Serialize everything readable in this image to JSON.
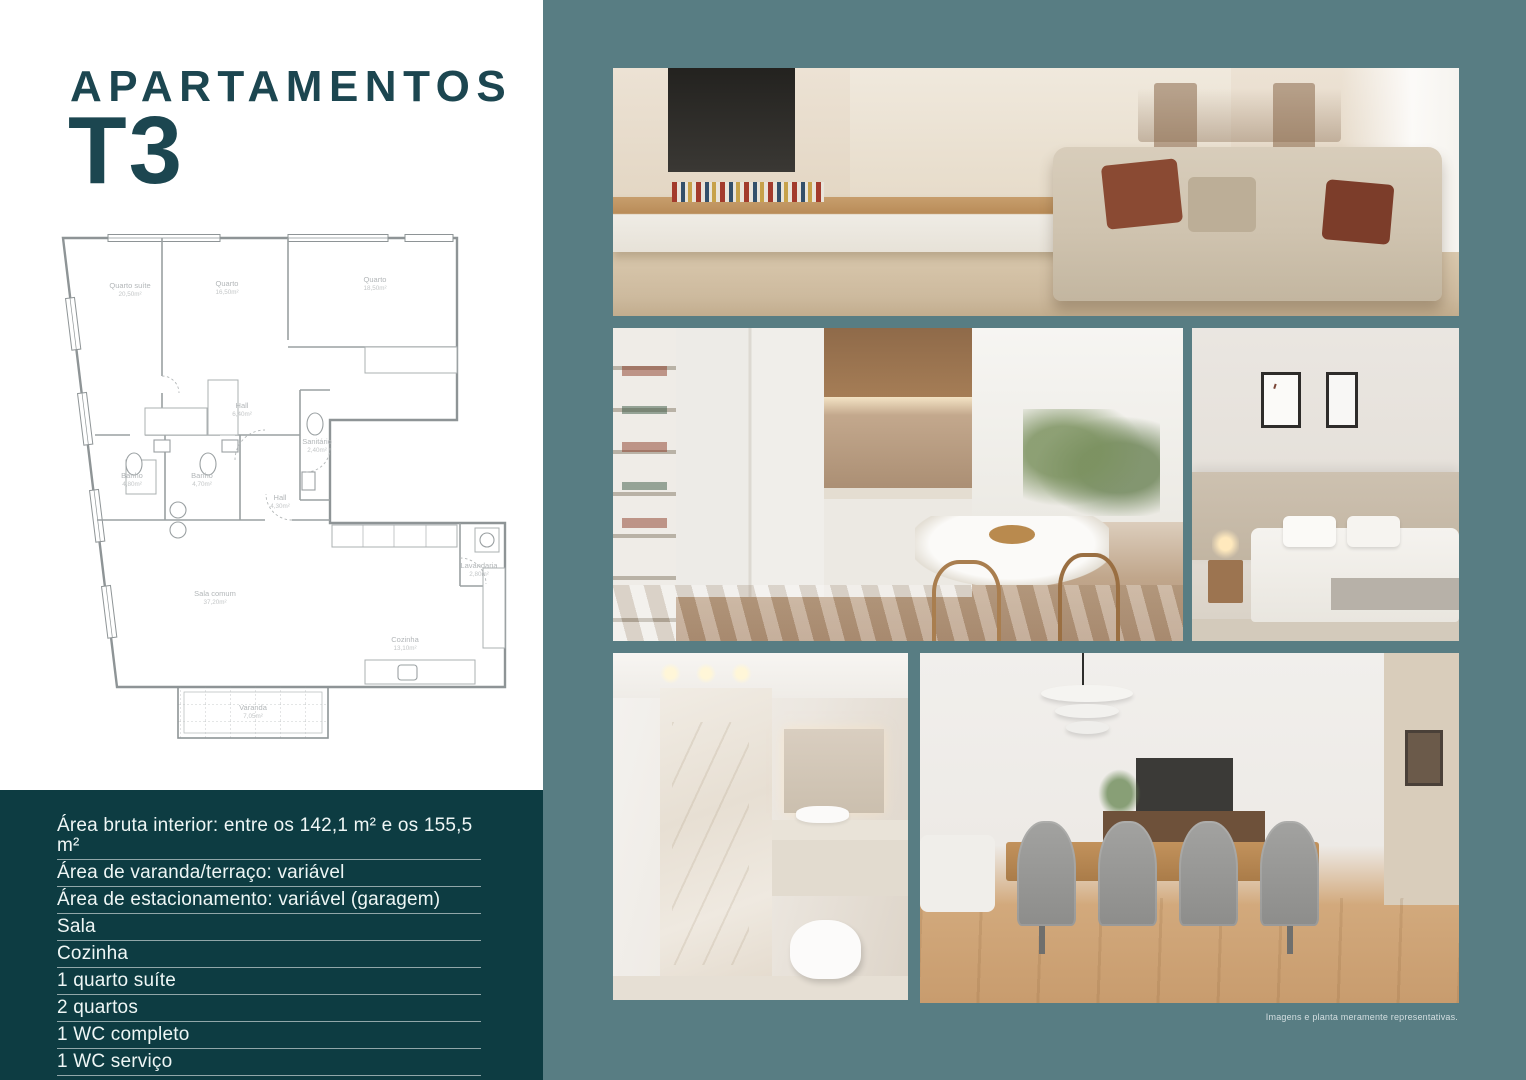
{
  "colors": {
    "panel_teal": "#587d83",
    "deep_teal": "#0d3c42",
    "title_teal": "#1c4650"
  },
  "title": {
    "line1": "APARTAMENTOS",
    "line2": "T3"
  },
  "floorplan": {
    "rooms": [
      {
        "name": "Quarto suíte",
        "area": "20,50m²"
      },
      {
        "name": "Quarto",
        "area": "16,50m²"
      },
      {
        "name": "Quarto",
        "area": "18,50m²"
      },
      {
        "name": "Hall",
        "area": "6,40m²"
      },
      {
        "name": "Sanitário",
        "area": "2,40m²"
      },
      {
        "name": "Banho",
        "area": "4,80m²"
      },
      {
        "name": "Banho",
        "area": "4,70m²"
      },
      {
        "name": "Hall",
        "area": "4,30m²"
      },
      {
        "name": "Sala comum",
        "area": "37,20m²"
      },
      {
        "name": "Cozinha",
        "area": "13,10m²"
      },
      {
        "name": "Lavandaria",
        "area": "2,80m²"
      },
      {
        "name": "Varanda",
        "area": "7,05m²"
      }
    ]
  },
  "specs": {
    "items": [
      "Área bruta interior: entre os 142,1 m² e os 155,5 m²",
      "Área de varanda/terraço: variável",
      "Área de estacionamento: variável (garagem)",
      "Sala",
      "Cozinha",
      "1 quarto suíte",
      "2 quartos",
      "1 WC completo",
      "1 WC serviço"
    ]
  },
  "gallery": {
    "caption": "Imagens e planta meramente representativas.",
    "photos": [
      {
        "name": "living-room"
      },
      {
        "name": "kitchen"
      },
      {
        "name": "bedroom"
      },
      {
        "name": "bathroom"
      },
      {
        "name": "dining-room"
      }
    ]
  }
}
